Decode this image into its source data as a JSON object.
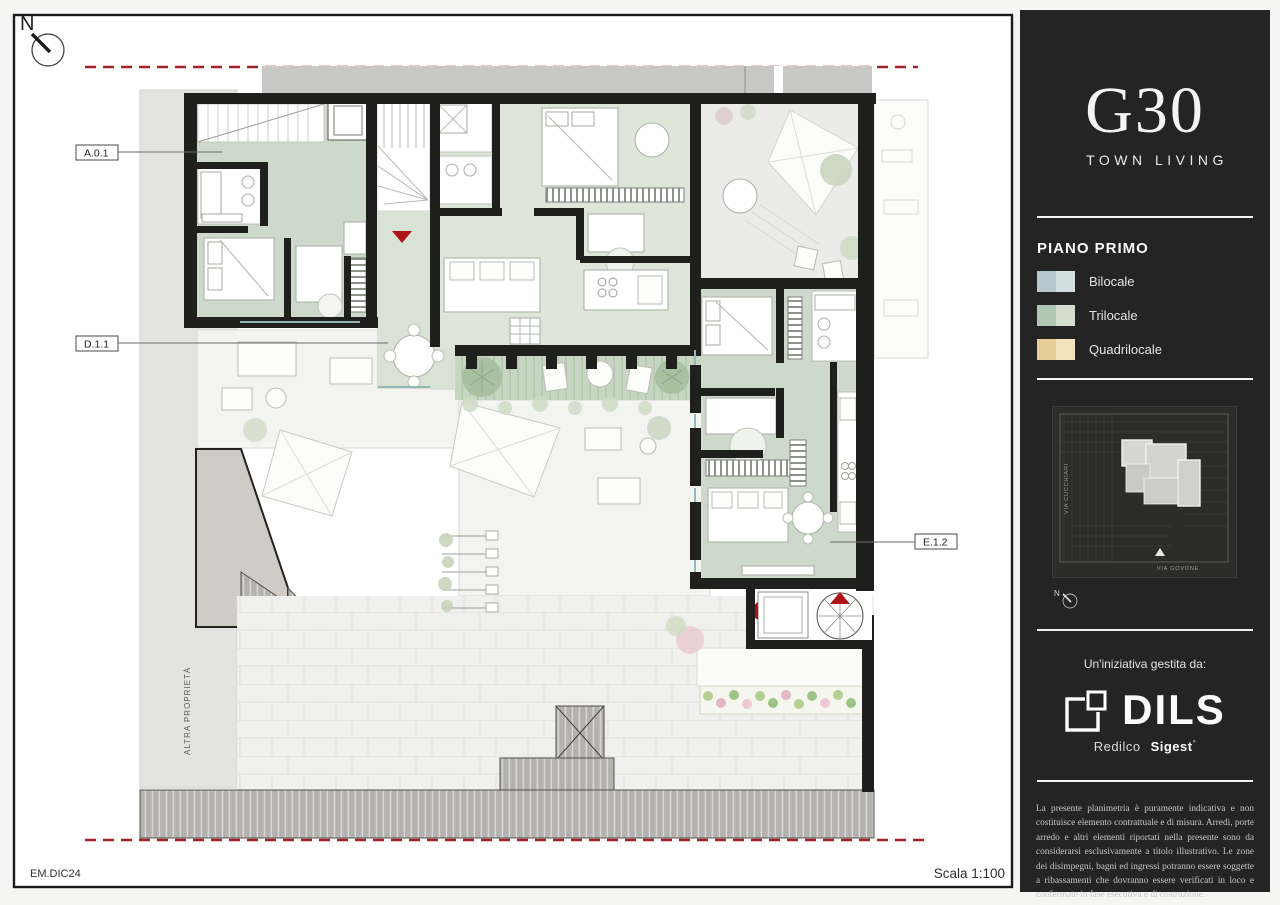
{
  "plan": {
    "north_label": "N",
    "other_property": "ALTRA PROPRIETÀ",
    "labels": {
      "a01": "A.0.1",
      "d11": "D.1.1",
      "e12": "E.1.2"
    },
    "footer_left": "EM.DIC24",
    "footer_right": "Scala 1:100",
    "colors": {
      "wall": "#1f1f1d",
      "trilocale_room": "#cdd9ca",
      "terrace": "#ebebe9",
      "red_line": "#a2242b",
      "red_marker": "#ad1217"
    }
  },
  "sidebar": {
    "brand": {
      "name": "G30",
      "tagline": "TOWN LIVING"
    },
    "legend": {
      "title": "PIANO PRIMO",
      "items": [
        {
          "label": "Bilocale",
          "color_dark": "#b7c9ce",
          "color_light": "#d3dfe2"
        },
        {
          "label": "Trilocale",
          "color_dark": "#b0c5b2",
          "color_light": "#d3decf"
        },
        {
          "label": "Quadrilocale",
          "color_dark": "#e6cd98",
          "color_light": "#f2e3bd"
        }
      ]
    },
    "minimap": {
      "street_left": "VIA CUCCHIARI",
      "street_bottom": "VIA GOVONE",
      "north_label": "N"
    },
    "initiative": {
      "intro": "Un'iniziativa gestita da:",
      "logo": "DILS",
      "brand1": "Redilco",
      "brand2": "Sigest",
      "brand2_mark": "°"
    },
    "disclaimer": "La presente planimetria è puramente indicativa e non costituisce elemento contrattuale e di misura. Arredi, porte arredo e altri elementi riportati nella presente sono da considerarsi esclusivamente a titolo illustrativo. Le zone dei disimpegni, bagni ed ingressi potranno essere soggette a ribassamenti che dovranno essere verificati in loco e confermate in fase esecutiva e di costruzione."
  }
}
